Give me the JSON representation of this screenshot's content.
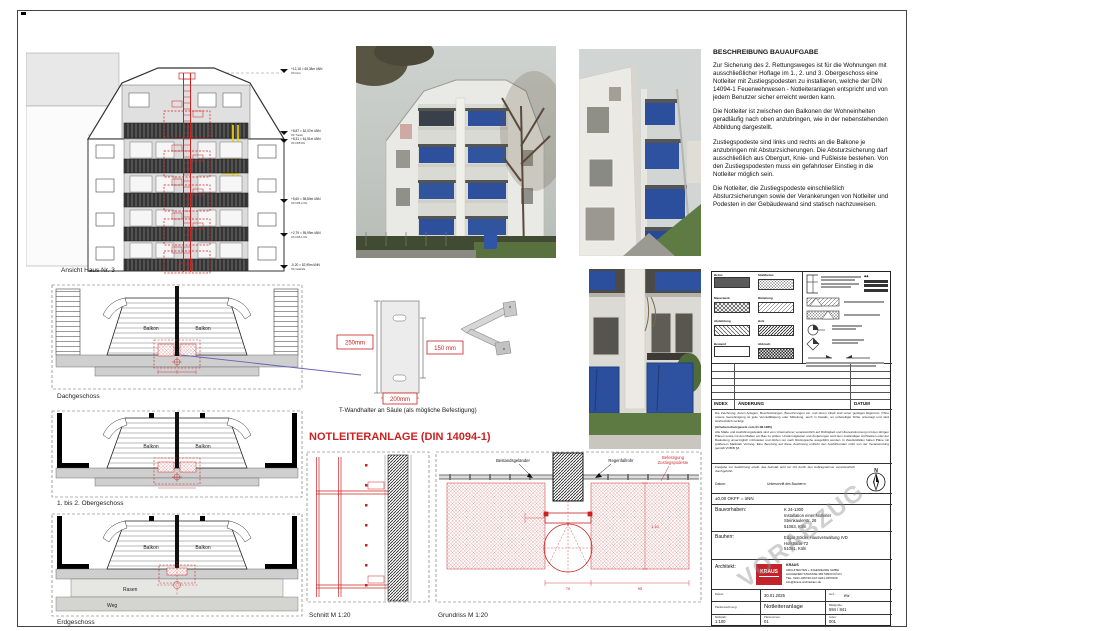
{
  "heading": "NOTLEITERANLAGE (DIN 14094-1)",
  "elevation": {
    "caption": "Ansicht Haus Nr. 3",
    "levels": [
      {
        "main": "+12,18 = 65,38m üNN",
        "sub": "OK First"
      },
      {
        "main": "+8,87 = 62,07m üNN",
        "sub": "OK Traufe"
      },
      {
        "main": "+8,31 = 61,51m üNN",
        "sub": "OK FFB DG"
      },
      {
        "main": "+5,60 = 58,80m üNN",
        "sub": "OK FFB 2.OG"
      },
      {
        "main": "+2,79 = 55,99m üNN",
        "sub": "OK FFB 1.OG"
      },
      {
        "main": "-0,20 = 52,99m üNN",
        "sub": "OK Gelände"
      }
    ]
  },
  "description": {
    "title": "BESCHREIBUNG BAUAUFGABE",
    "p1": "Zur Sicherung des 2. Rettungsweges ist für die Wohnungen mit ausschließlicher Hoflage im 1., 2. und 3. Obergeschoss eine Notleiter mit Zustiegspodesten zu installieren, welche der DIN 14094-1 Feuerwehrwesen - Notleiteranlagen entspricht und von jedem Benutzer sicher erreicht werden kann.",
    "p2": "Die Notleiter ist zwischen den Balkonen der Wohneinheiten geradläufig nach oben anzubringen, wie in der nebenstehenden Abbildung dargestellt.",
    "p3": "Zustiegspodeste sind links und rechts an die Balkone je anzubringen mit Absturzsicherungen. Die Absturzsicherung darf ausschließlich aus Obergurt, Knie- und Fußleiste bestehen. Von den Zustiegspodesten muss ein gefahrloser Einstieg in die Notleiter möglich sein.",
    "p4": "Die Notleiter, die Zustiegspodeste einschließlich Absturzsicherungen sowie der Verankerungen von Notleiter und Podesten in der Gebäudewand sind statisch nachzuweisen."
  },
  "plans": {
    "dg": "Dachgeschoss",
    "og": "1. bis 2. Obergeschoss",
    "eg": "Erdgeschoss",
    "balkon": "Balkon",
    "rasen": "Rasen",
    "weg": "Weg"
  },
  "detail": {
    "dim_h": "250mm",
    "dim_slot": "150 mm",
    "dim_w": "200mm",
    "caption": "T-Wandhalter an Säule (als mögliche Befestigung)"
  },
  "section": {
    "caption": "Schnitt M 1:20"
  },
  "grundriss": {
    "caption": "Grundriss M 1:20",
    "label_left": "Bestandsgeländer",
    "label_right": "Regenfallrohr",
    "label_red1": "Befestigung",
    "label_red2": "Zustiegspodeste",
    "dim1": "70",
    "dim2": "95",
    "dim3": "1,10"
  },
  "titleblock": {
    "legend": [
      {
        "label": "Beton"
      },
      {
        "label": "Stahlbeton"
      },
      {
        "label": "Mauerwerk"
      },
      {
        "label": "Dämmung"
      },
      {
        "label": "Abdichtung"
      },
      {
        "label": "Holz"
      },
      {
        "label": "Bestand"
      },
      {
        "label": "Abbruch"
      }
    ],
    "index_header": {
      "col1": "INDEX",
      "col2": "ÄNDERUNG",
      "col3": "DATUM"
    },
    "legal1": "Die Zeichnung, deren Anlagen, Beschreibungen, Berechnungen etc. und deren Inhalt sind unser geistiges Eigentum. Ohne unsere Genehmigung ist jede Vervielfältigung oder Mitteilung, auch in Details, an unbeteiligte Dritte untersagt und wird strafrechtlich verfolgt.",
    "legal2": "(Urheberschutzgesetz vom 01.08.1965)",
    "legal3": "Alle Maße und Ausführungsdetails sind vom Unternehmer verantwortlich auf Richtigkeit und Übereinstimmung mit den übrigen Plänen sowie mit den Maßen am Bau zu prüfen. Unstimmigkeiten und Änderungen sind dem zuständigen Architekten oder der Bauleitung unverzüglich mitzuteilen und dürfen nur nach Rücksprache ausgeführt werden. In Zweifelsfällen haben Pläne mit größerem Maßstab Vorrang. Eine Berufung auf diese Zeichnung enthebt den Ausführenden nicht von der Verantwortung gemäß VOB/B §3.",
    "freigabe": "Freigabe zur Ausführung erteilt, das Aufmaß wird vor Ort durch den Auftragnehmer verantwortlich durchgeführt.",
    "datum_label": "Datum:",
    "unterschrift": "Unterschrift des Bauherrn",
    "kote": "±0,00 OKFF = üNN",
    "north": "N",
    "rows": {
      "bauvorhaben_label": "Bauvorhaben:",
      "bauvorhaben": [
        "K 24-1300",
        "Installation einer Notleiter",
        "Steinkaulerstr. 26",
        "51063, Köln"
      ],
      "bauherr_label": "Bauherr:",
      "bauherr": [
        "Edgar Sölder Hausverwaltung IVD",
        "Hofstraße 72",
        "51061, Köln"
      ],
      "architekt_label": "Architekt:",
      "logo": "KRAUS",
      "architekt": [
        "KRAUS",
        "ARCHITEKTEN + INGENIEURE GMBH",
        "AACHENER STRASSE 382   50933 KÖLN",
        "TEL. 0221-345740   FAX 0221-3457609",
        "info@kraus-architekten.de"
      ]
    },
    "bottom": {
      "datum_label": "Datum:",
      "datum": "30.01.2025",
      "gez_label": "Gez.:",
      "gez": "ew",
      "bez_label": "Planbezeichnung:",
      "bez": "Notleiteranlage",
      "blatt_label": "Blattgröße:",
      "blatt": "594 / 841",
      "mass_label": "Maßstab:",
      "mass": "1:100",
      "plannr_label": "Plannummer:",
      "plannr": "01",
      "index_label": "Index:",
      "index": "001"
    },
    "watermark": "VORABZUG"
  },
  "colors": {
    "accent_red": "#cc2222",
    "highlight_yellow": "#f5d800",
    "tarp_blue": "#2b4e9d",
    "logo_red": "#c4232b"
  }
}
